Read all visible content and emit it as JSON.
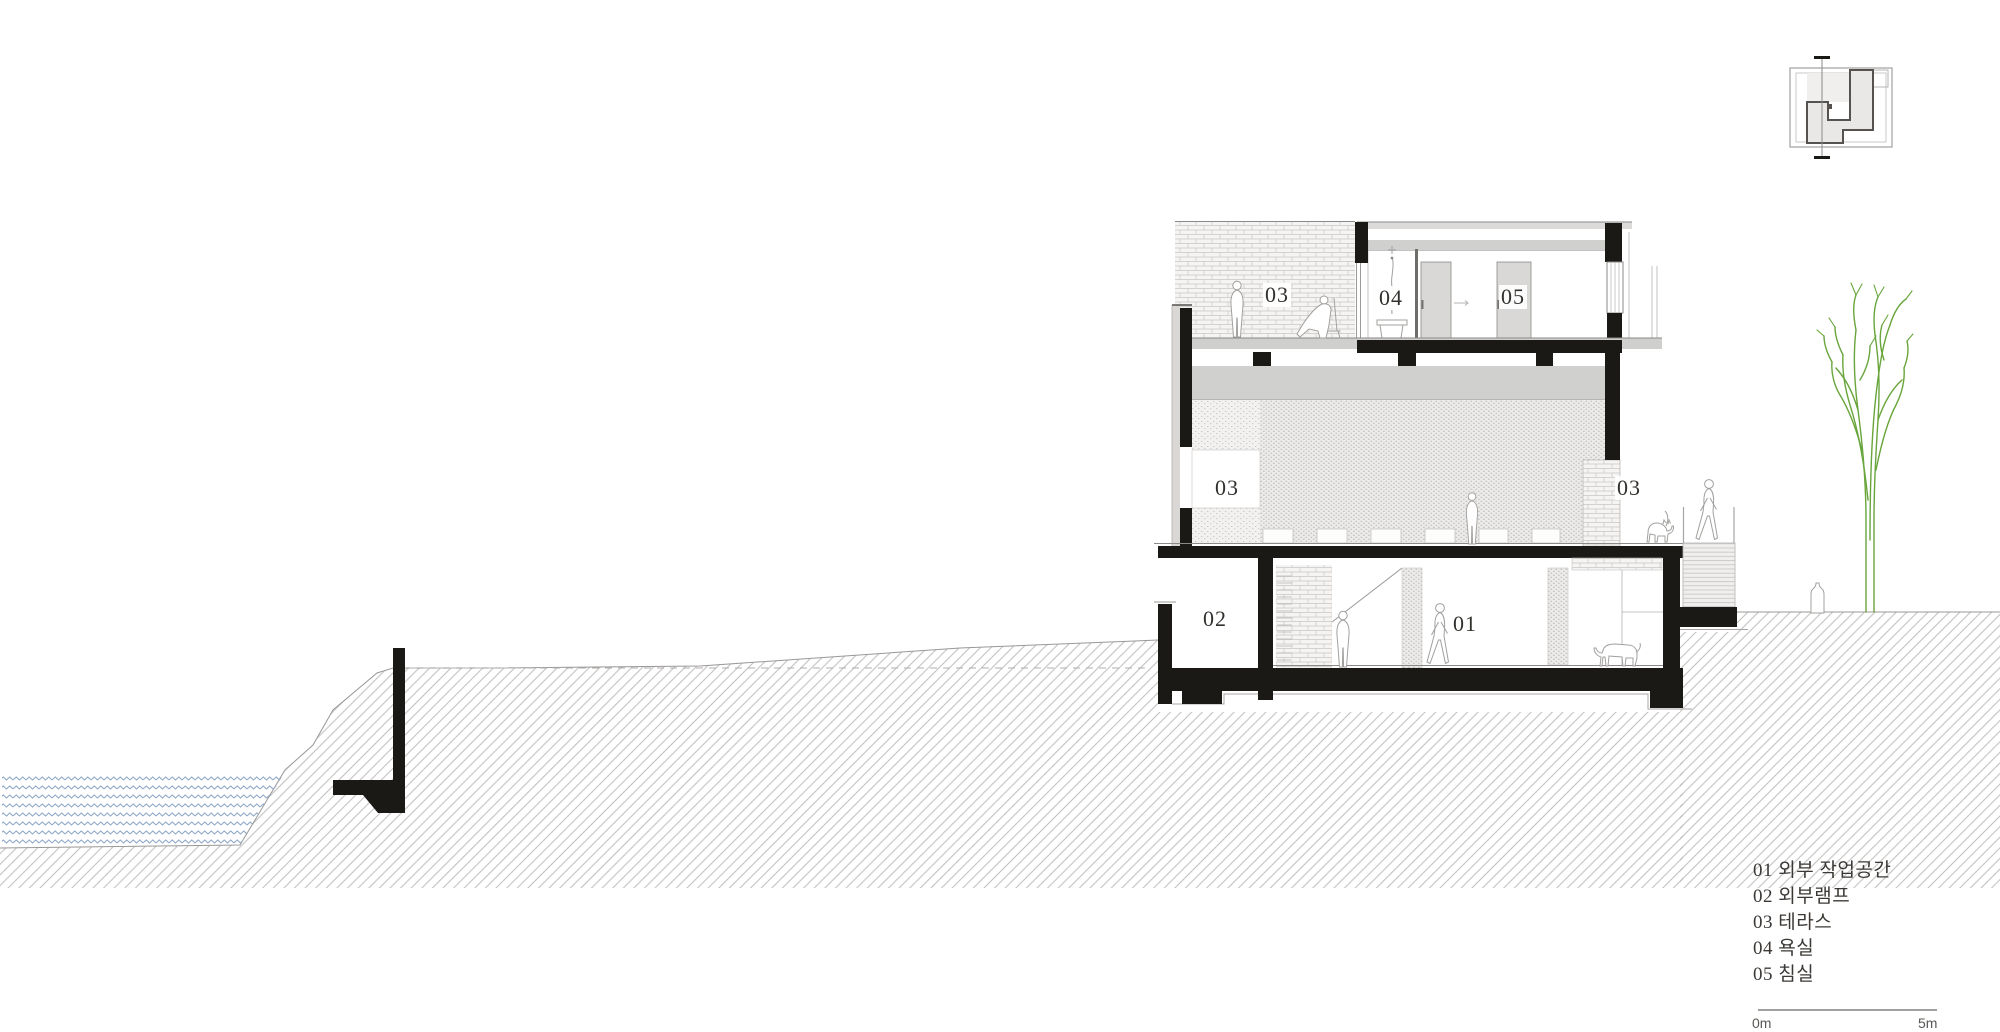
{
  "title": "건물 단면도 (building section drawing)",
  "labels": {
    "terrace_upper": "03",
    "bathroom": "04",
    "bedroom": "05",
    "terrace_mid_left": "03",
    "terrace_mid_right": "03",
    "exterior_ramp": "02",
    "exterior_workspace": "01"
  },
  "rooms": [
    {
      "number": "01",
      "name": "외부 작업공간"
    },
    {
      "number": "02",
      "name": "외부램프"
    },
    {
      "number": "03",
      "name": "테라스"
    },
    {
      "number": "04",
      "name": "욕실"
    },
    {
      "number": "05",
      "name": "침실"
    }
  ],
  "legend_items": [
    "01 외부 작업공간",
    "02 외부램프",
    "03 테라스",
    "04 욕실",
    "05 침실"
  ],
  "scale": {
    "start_label": "0m",
    "end_label": "5m"
  },
  "colors": {
    "cut_wall": "#1b1916",
    "slab_gray": "#cfcfcd",
    "ground_hatch": "#b7b5b3",
    "water": "#8fa8c8",
    "tree": "#68a53b",
    "text": "#33312e"
  }
}
